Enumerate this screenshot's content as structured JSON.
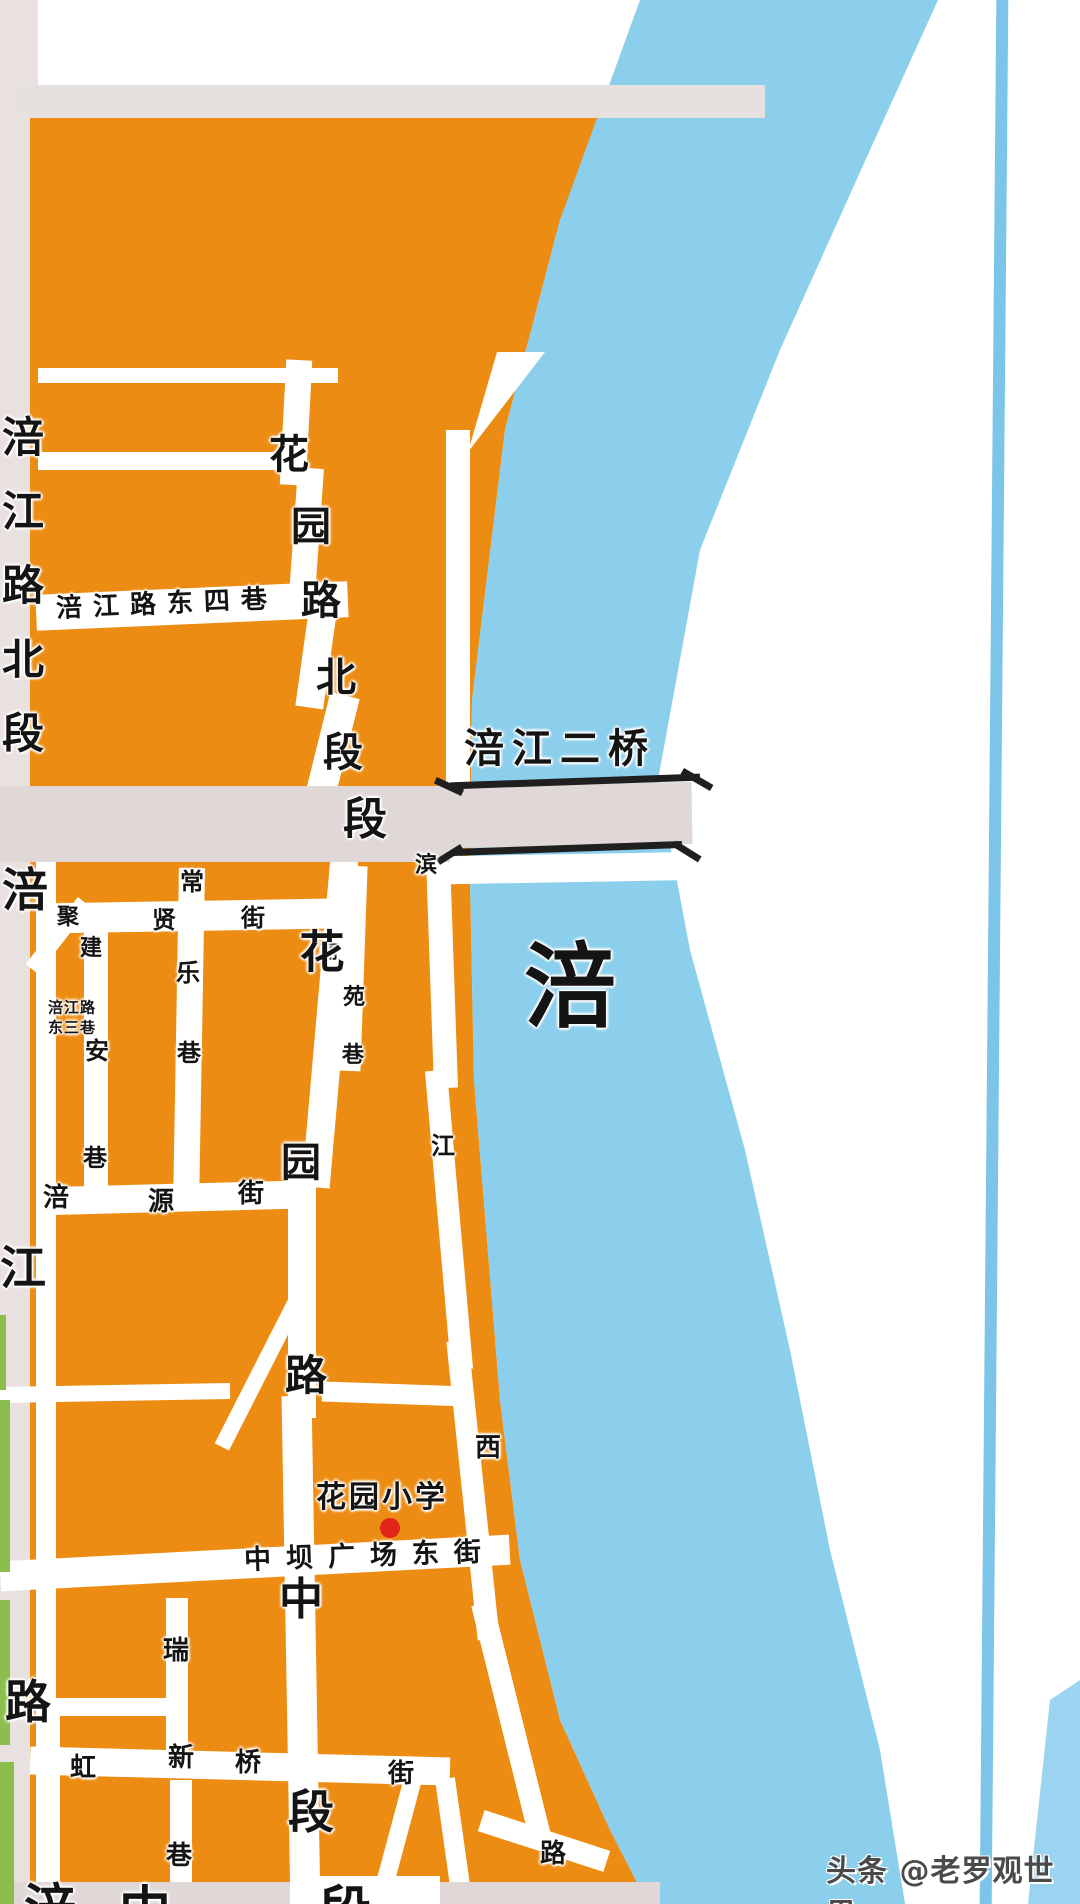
{
  "map": {
    "title": "绵阳涪江城区街道地图片段",
    "colors": {
      "district_orange": "#ED8C12",
      "river_blue": "#8CCFEC",
      "road_grey": "#DFD8D6",
      "strip_grey": "#E9E1E0",
      "green_strip": "#8CBE4E",
      "bridge_black": "#1F1F1F",
      "poi_red": "#E2251B"
    },
    "river_label": "涪",
    "bridge_label": "涪江二桥",
    "school_label": "花园小学",
    "labels": [
      {
        "n": "road-fujiang-road-north-label",
        "t": "涪\n江\n路\n北\n段",
        "x": 23,
        "y": 586,
        "s": 42,
        "lh": 74
      },
      {
        "n": "road-fujiang-char-fu",
        "t": "涪",
        "x": 25,
        "y": 890,
        "s": 46
      },
      {
        "n": "road-fujiang-char-jiang",
        "t": "江",
        "x": 23,
        "y": 1268,
        "s": 46
      },
      {
        "n": "road-fujiang-char-lu",
        "t": "路",
        "x": 28,
        "y": 1702,
        "s": 46
      },
      {
        "n": "road-huayuan-north-char",
        "t": "花",
        "x": 289,
        "y": 455,
        "s": 40
      },
      {
        "n": "road-huayuan-north-char",
        "t": "园",
        "x": 311,
        "y": 527,
        "s": 40
      },
      {
        "n": "road-huayuan-north-char",
        "t": "路",
        "x": 321,
        "y": 601,
        "s": 40
      },
      {
        "n": "road-huayuan-north-char",
        "t": "北",
        "x": 336,
        "y": 678,
        "s": 40
      },
      {
        "n": "road-huayuan-north-char",
        "t": "段",
        "x": 343,
        "y": 753,
        "s": 40
      },
      {
        "n": "road-duan-char",
        "t": "段",
        "x": 365,
        "y": 820,
        "s": 44
      },
      {
        "n": "bridge-fujiang-erqiao-label",
        "t": "涪江二桥",
        "x": 560,
        "y": 749,
        "s": 40,
        "ls": 8
      },
      {
        "n": "river-fu-label",
        "t": "涪",
        "x": 570,
        "y": 988,
        "s": 92
      },
      {
        "n": "road-fujianglu-dongsixiang-label",
        "t": "涪江路东四巷",
        "x": 167,
        "y": 604,
        "s": 26,
        "ls": 11,
        "r": -2.5
      },
      {
        "n": "road-fujianglu-dongsanxiang-line1",
        "t": "涪江路",
        "x": 72,
        "y": 1008,
        "s": 15,
        "ls": 1
      },
      {
        "n": "road-fujianglu-dongsanxiang-line2",
        "t": "东三巷",
        "x": 72,
        "y": 1028,
        "s": 15,
        "ls": 1
      },
      {
        "n": "road-jujian-char",
        "t": "聚",
        "x": 68,
        "y": 918,
        "s": 22
      },
      {
        "n": "road-jujian-char",
        "t": "建",
        "x": 91,
        "y": 949,
        "s": 22
      },
      {
        "n": "road-chang-char",
        "t": "常",
        "x": 192,
        "y": 882,
        "s": 24
      },
      {
        "n": "road-xian-char",
        "t": "贤",
        "x": 164,
        "y": 920,
        "s": 24
      },
      {
        "n": "road-jie-char",
        "t": "街",
        "x": 253,
        "y": 918,
        "s": 24
      },
      {
        "n": "road-le-char",
        "t": "乐",
        "x": 188,
        "y": 973,
        "s": 24
      },
      {
        "n": "road-xiang-char",
        "t": "巷",
        "x": 189,
        "y": 1053,
        "s": 24
      },
      {
        "n": "road-an-char",
        "t": "安",
        "x": 97,
        "y": 1051,
        "s": 24
      },
      {
        "n": "road-xiang-char",
        "t": "巷",
        "x": 95,
        "y": 1158,
        "s": 24
      },
      {
        "n": "road-liyuanxiang-char",
        "t": "丽",
        "x": 329,
        "y": 953,
        "s": 18
      },
      {
        "n": "road-liyuanxiang-char",
        "t": "苑",
        "x": 354,
        "y": 998,
        "s": 22
      },
      {
        "n": "road-liyuanxiang-char",
        "t": "巷",
        "x": 353,
        "y": 1056,
        "s": 22
      },
      {
        "n": "road-binjiang-char",
        "t": "滨",
        "x": 426,
        "y": 866,
        "s": 22
      },
      {
        "n": "road-binjiang-char",
        "t": "江",
        "x": 443,
        "y": 1146,
        "s": 24
      },
      {
        "n": "road-binjiang-char",
        "t": "西",
        "x": 488,
        "y": 1448,
        "s": 26
      },
      {
        "n": "road-fuyuanjie-char",
        "t": "涪",
        "x": 56,
        "y": 1198,
        "s": 26
      },
      {
        "n": "road-fuyuanjie-char",
        "t": "源",
        "x": 161,
        "y": 1202,
        "s": 26
      },
      {
        "n": "road-fuyuanjie-char",
        "t": "街",
        "x": 251,
        "y": 1194,
        "s": 26
      },
      {
        "n": "road-huayuan-mid-char",
        "t": "花",
        "x": 322,
        "y": 952,
        "s": 45
      },
      {
        "n": "road-huayuan-mid-char",
        "t": "园",
        "x": 301,
        "y": 1163,
        "s": 40
      },
      {
        "n": "road-huayuan-mid-char",
        "t": "路",
        "x": 306,
        "y": 1376,
        "s": 42
      },
      {
        "n": "road-huayuan-mid-char",
        "t": "中",
        "x": 301,
        "y": 1600,
        "s": 44
      },
      {
        "n": "road-huayuan-mid-char",
        "t": "段",
        "x": 311,
        "y": 1812,
        "s": 46
      },
      {
        "n": "poi-huayuan-school-label",
        "t": "花园小学",
        "x": 382,
        "y": 1498,
        "s": 30,
        "ls": 3
      },
      {
        "n": "road-zhongba-guangchang-dongjie-label",
        "t": "中坝广场东街",
        "x": 370,
        "y": 1556,
        "s": 27,
        "ls": 15,
        "r": -2
      },
      {
        "n": "road-rui-char",
        "t": "瑞",
        "x": 176,
        "y": 1651,
        "s": 26
      },
      {
        "n": "road-hong-char",
        "t": "虹",
        "x": 83,
        "y": 1768,
        "s": 26
      },
      {
        "n": "road-xin-char",
        "t": "新",
        "x": 181,
        "y": 1758,
        "s": 26
      },
      {
        "n": "road-qiao-char",
        "t": "桥",
        "x": 248,
        "y": 1763,
        "s": 26
      },
      {
        "n": "road-jie-char",
        "t": "街",
        "x": 401,
        "y": 1774,
        "s": 26
      },
      {
        "n": "road-xiang-char",
        "t": "巷",
        "x": 179,
        "y": 1856,
        "s": 26
      },
      {
        "n": "road-lu-char",
        "t": "路",
        "x": 553,
        "y": 1854,
        "s": 26
      },
      {
        "n": "road-partial-bottom-char",
        "t": "涪",
        "x": 50,
        "y": 1910,
        "s": 52
      },
      {
        "n": "road-partial-bottom-char",
        "t": "中",
        "x": 145,
        "y": 1912,
        "s": 52
      },
      {
        "n": "road-partial-bottom-char",
        "t": "段",
        "x": 345,
        "y": 1912,
        "s": 52
      }
    ],
    "watermark": {
      "text": "头条 @老罗观世界"
    }
  }
}
